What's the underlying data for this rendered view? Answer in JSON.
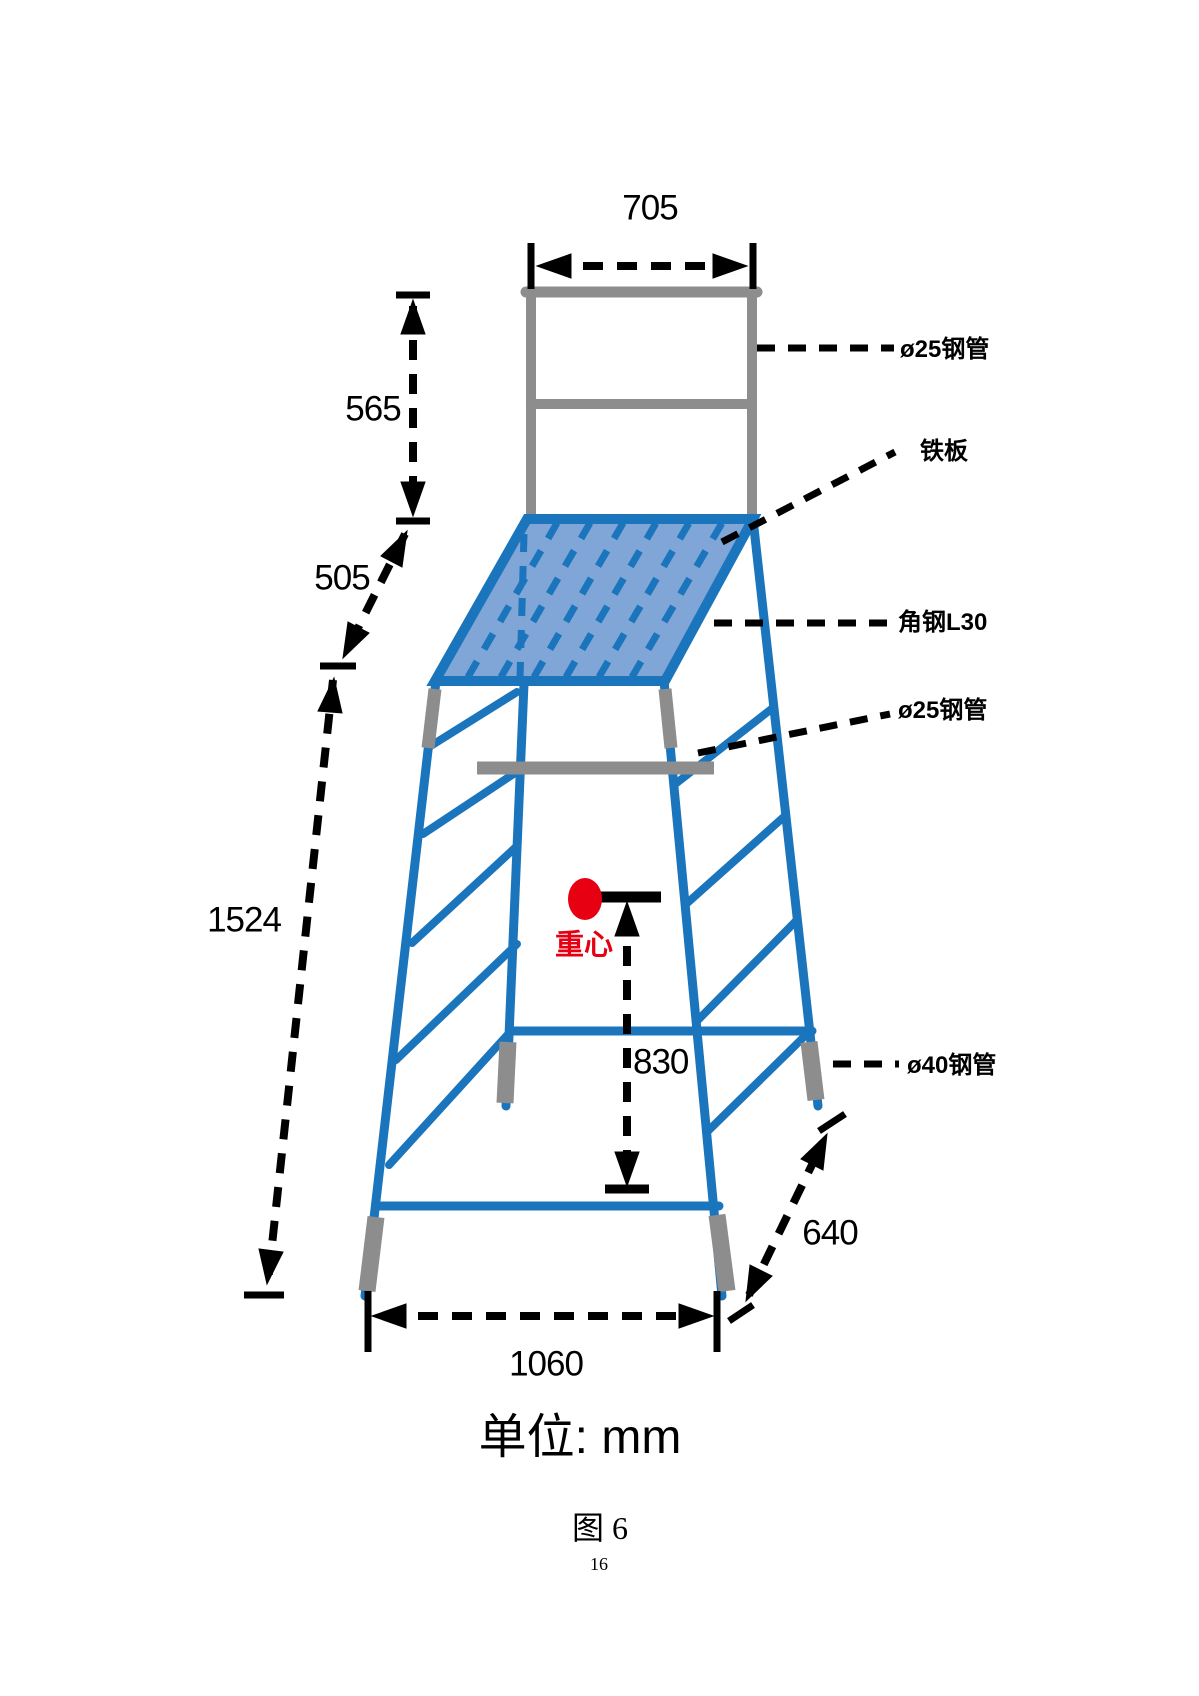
{
  "figure": {
    "unit_label": "单位: mm",
    "caption": "图 6",
    "page_number": "16"
  },
  "dimensions": {
    "top_width": "705",
    "backrest_height": "565",
    "seat_offset": "505",
    "total_height": "1524",
    "cg_height": "830",
    "base_depth": "640",
    "base_width": "1060"
  },
  "part_labels": {
    "pipe25_top": "ø25钢管",
    "iron_plate": "铁板",
    "angle_steel_l30": "角钢L30",
    "pipe25_mid": "ø25钢管",
    "pipe40_foot": "ø40钢管"
  },
  "center_of_gravity": {
    "label": "重心"
  },
  "colors": {
    "frame_blue": "#1b75bc",
    "plate_fill": "#7fa6d6",
    "steel_gray": "#8d8d8d",
    "dimension_black": "#000000",
    "cg_red": "#e60012"
  }
}
